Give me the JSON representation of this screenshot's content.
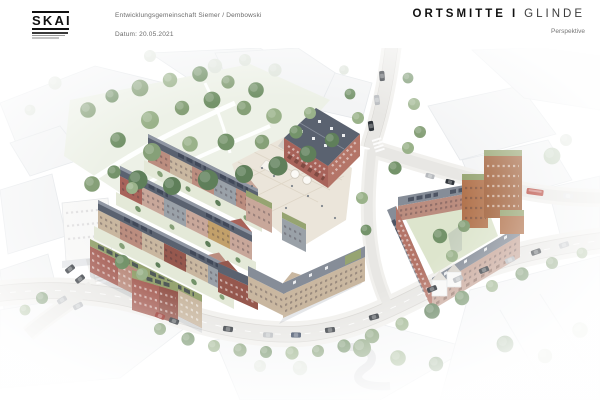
{
  "header": {
    "logo": {
      "name": "SKAI"
    },
    "project": "Entwicklungsgemeinschaft Siemer / Dembowski",
    "date": "Datum: 20.05.2021",
    "title": {
      "left": "ORTSMITTE",
      "separator": "I",
      "right": "GLINDE"
    },
    "subtitle": "Perspektive"
  },
  "palette": {
    "page-bg": "#ffffff",
    "ink": "#111111",
    "muted-text": "#6a6a6a",
    "ctx-fill": "#f3f4f5",
    "ctx-stroke": "#e4e7ea",
    "fg-fill": "#f6f7f8",
    "lawn": "#edf1e7",
    "courtyard": "#dde5cd",
    "road": "#e8e7e4",
    "sidewalk": "#f1f0ed",
    "road-edge": "#d8d6d2",
    "plaza": "#ebe5da",
    "plaza-line": "#d9d0c0",
    "brick-red": "#a8635a",
    "brick-red-light": "#b47568",
    "brick-deep": "#96584e",
    "brick-pink": "#bb8d7f",
    "brick-rose": "#c8a79a",
    "brick-tan": "#c9b7a0",
    "brick-grey": "#9aa1a8",
    "brick-gold": "#c2a06a",
    "roof-dark": "#5a6270",
    "roof-mid": "#868d98",
    "roof-light": "#99a0ab",
    "roof-green": "#96a471",
    "solar": "#3a4252",
    "copper": "#b2744e",
    "copper-dark": "#a2633d",
    "white-bld": "#f8f8f7",
    "white-bld-stroke": "#e2e4e6",
    "tree-green": "#86a078",
    "tree-dark": "#5f7f5a",
    "tree-mid": "#74936a",
    "tree-light": "#9ab28a",
    "tree-pale": "#c3d2bd",
    "tree-faded": "#dfe5dc",
    "car-dark": "#30353b",
    "car-grey": "#b7babe",
    "car-red": "#97312a",
    "car-blue": "#3c4a63",
    "bus-red": "#b23a2e",
    "shadow": "rgba(90,100,118,0.16)"
  }
}
